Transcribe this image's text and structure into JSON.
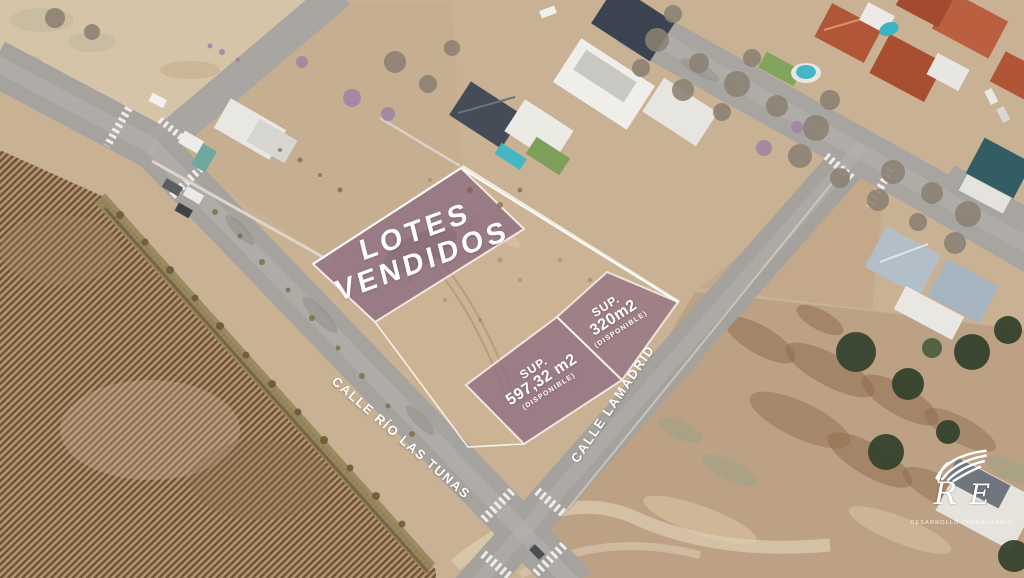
{
  "overlays": {
    "sold": {
      "line1": "LOTES",
      "line2": "VENDIDOS"
    },
    "lot_597": {
      "sup_label": "SUP.",
      "area": "597,32 m2",
      "status": "(DISPONIBLE)"
    },
    "lot_320": {
      "sup_label": "SUP.",
      "area": "320m2",
      "status": "(DISPONIBLE)"
    }
  },
  "streets": {
    "rio_las_tunas": "CALLE RÍO LAS TUNAS",
    "lamadrid": "CALLE LAMADRID"
  },
  "logo": {
    "monogram_left": "R",
    "monogram_right": "E",
    "tagline": "DESARROLLO INMOBILIARIO"
  },
  "colors": {
    "overlay_purple": "#8f6f82",
    "road_gray": "#a6a39e",
    "dirt_tan": "#c9b294",
    "field_light": "#d6c4a8",
    "furrow_dark": "#6e5138",
    "furrow_light": "#b3946f",
    "scrub_tan": "#bda184",
    "roof_red": "#b25638",
    "roof_slate": "#454c58",
    "pool_teal": "#45b6c3",
    "tree_green": "#36432e",
    "line_white": "#ffffff"
  }
}
